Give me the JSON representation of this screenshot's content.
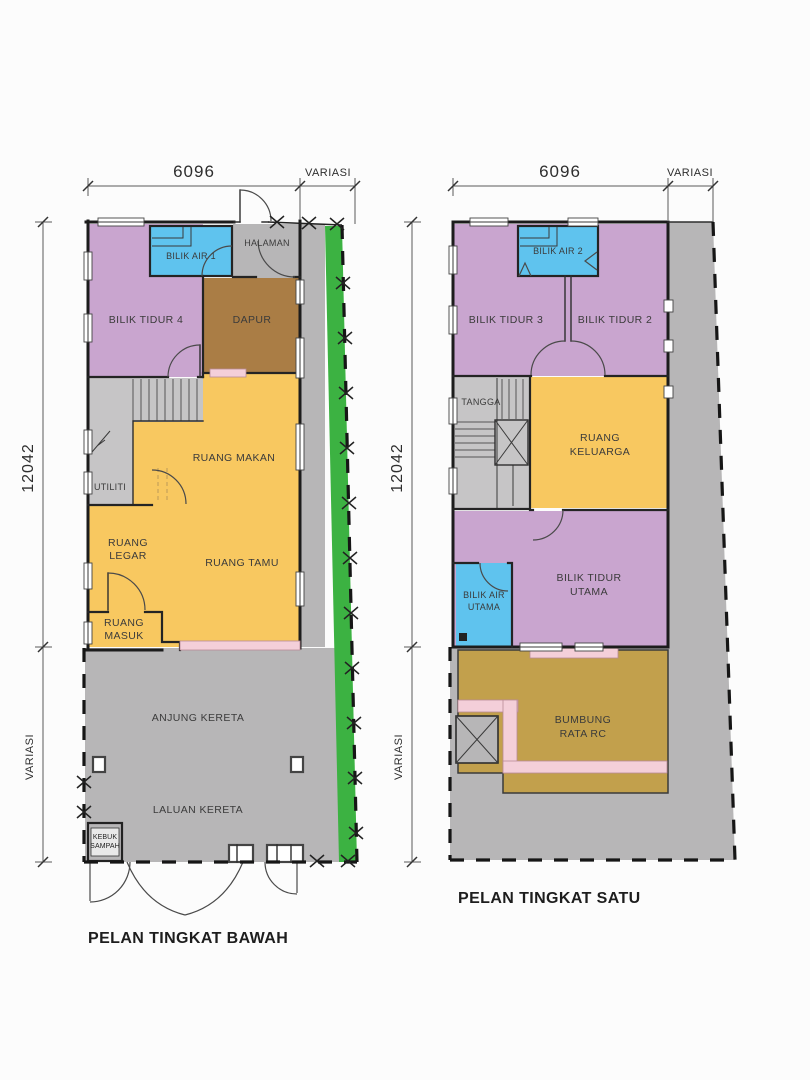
{
  "plans": {
    "ground": {
      "title": "PELAN TINGKAT BAWAH",
      "dims": {
        "top_width": "6096",
        "top_variable": "VARIASI",
        "side_height": "12042",
        "side_variable": "VARIASI"
      },
      "rooms": {
        "bilik_air_1": "BILIK AIR 1",
        "halaman": "HALAMAN",
        "bilik_tidur_4": "BILIK TIDUR 4",
        "dapur": "DAPUR",
        "ruang_makan": "RUANG MAKAN",
        "utiliti": "UTILITI",
        "ruang_legar": [
          "RUANG",
          "LEGAR"
        ],
        "ruang_tamu": "RUANG TAMU",
        "ruang_masuk": [
          "RUANG",
          "MASUK"
        ],
        "anjung_kereta": "ANJUNG KERETA",
        "laluan_kereta": "LALUAN KERETA",
        "kebuk_sampah": [
          "KEBUK",
          "SAMPAH"
        ]
      }
    },
    "first": {
      "title": "PELAN TINGKAT SATU",
      "dims": {
        "top_width": "6096",
        "top_variable": "VARIASI",
        "side_height": "12042",
        "side_variable": "VARIASI"
      },
      "rooms": {
        "bilik_air_2": "BILIK AIR 2",
        "bilik_tidur_3": "BILIK TIDUR 3",
        "bilik_tidur_2": "BILIK TIDUR 2",
        "tangga": "TANGGA",
        "ruang_keluarga": [
          "RUANG",
          "KELUARGA"
        ],
        "bilik_air_utama": [
          "BILIK AIR",
          "UTAMA"
        ],
        "bilik_tidur_utama": [
          "BILIK TIDUR",
          "UTAMA"
        ],
        "bumbung_rata_rc": [
          "BUMBUNG",
          "RATA RC"
        ]
      }
    }
  },
  "colors": {
    "bedroom_purple": "#c9a5cf",
    "bathroom_blue": "#5fc3ee",
    "living_yellow": "#f8c860",
    "kitchen_brown": "#aa7d45",
    "roof_tan": "#c2a04c",
    "garden_green": "#3cb242",
    "paving_gray": "#b7b6b7",
    "stair_gray": "#c6c5c6",
    "threshold_pink": "#f4cfd9",
    "wall_dark": "#1c1c1c",
    "drawing_background": "#fcfcfc"
  }
}
